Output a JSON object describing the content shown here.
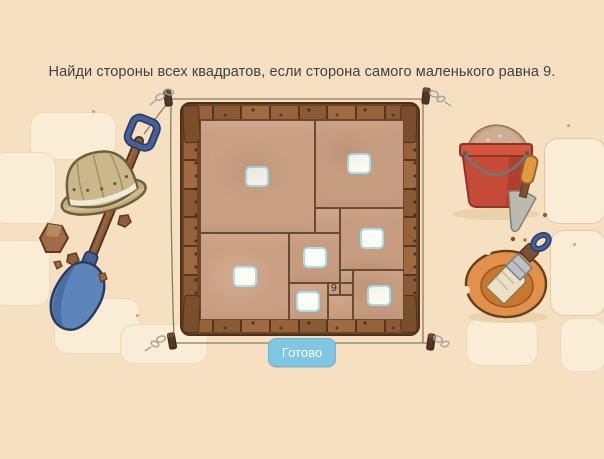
{
  "title": "Найди стороны всех квадратов, если сторона самого маленького равна 9.",
  "done_button": {
    "label": "Готово"
  },
  "puzzle": {
    "grid_units": 144,
    "given_side": "9",
    "squares": [
      {
        "id": "top-left",
        "x": 0,
        "y": 0,
        "size": 81,
        "input": true
      },
      {
        "id": "top-right",
        "x": 81,
        "y": 0,
        "size": 63,
        "input": true
      },
      {
        "id": "mid-small",
        "x": 81,
        "y": 63,
        "size": 18,
        "input": false
      },
      {
        "id": "right-mid",
        "x": 99,
        "y": 63,
        "size": 45,
        "input": true
      },
      {
        "id": "bottom-left",
        "x": 0,
        "y": 81,
        "size": 63,
        "input": true
      },
      {
        "id": "center",
        "x": 63,
        "y": 81,
        "size": 36,
        "input": true
      },
      {
        "id": "bottom-center",
        "x": 63,
        "y": 117,
        "size": 27,
        "input": true
      },
      {
        "id": "given-nine",
        "x": 90,
        "y": 117,
        "size": 9,
        "input": false,
        "label": "9"
      },
      {
        "id": "nine-upper",
        "x": 99,
        "y": 108,
        "size": 9,
        "input": false
      },
      {
        "id": "nine-lower",
        "x": 99,
        "y": 117,
        "size": 9,
        "input": false
      },
      {
        "id": "small-bottom",
        "x": 90,
        "y": 126,
        "size": 18,
        "input": false
      },
      {
        "id": "bottom-right",
        "x": 108,
        "y": 108,
        "size": 36,
        "input": true
      }
    ]
  },
  "decorations": [
    "shovel-icon",
    "pith-helmet-icon",
    "rock-icon",
    "survey-string",
    "survey-peg-icon",
    "sand-bucket-icon",
    "trowel-icon",
    "plate-icon",
    "brush-icon"
  ],
  "colors": {
    "background": "#f5e1c1",
    "frame_wood": "#8a5a34",
    "dirt": "#cba184",
    "grid_line": "#6b4a2f",
    "answer_border": "#a7dcec",
    "button": "#7ec6e2",
    "button_text": "#ffffff",
    "title_text": "#3f3f3f",
    "bucket_red": "#c64a38",
    "shovel_blue": "#5d85b9",
    "plate_orange": "#e2914a",
    "string": "#8c7b62"
  }
}
